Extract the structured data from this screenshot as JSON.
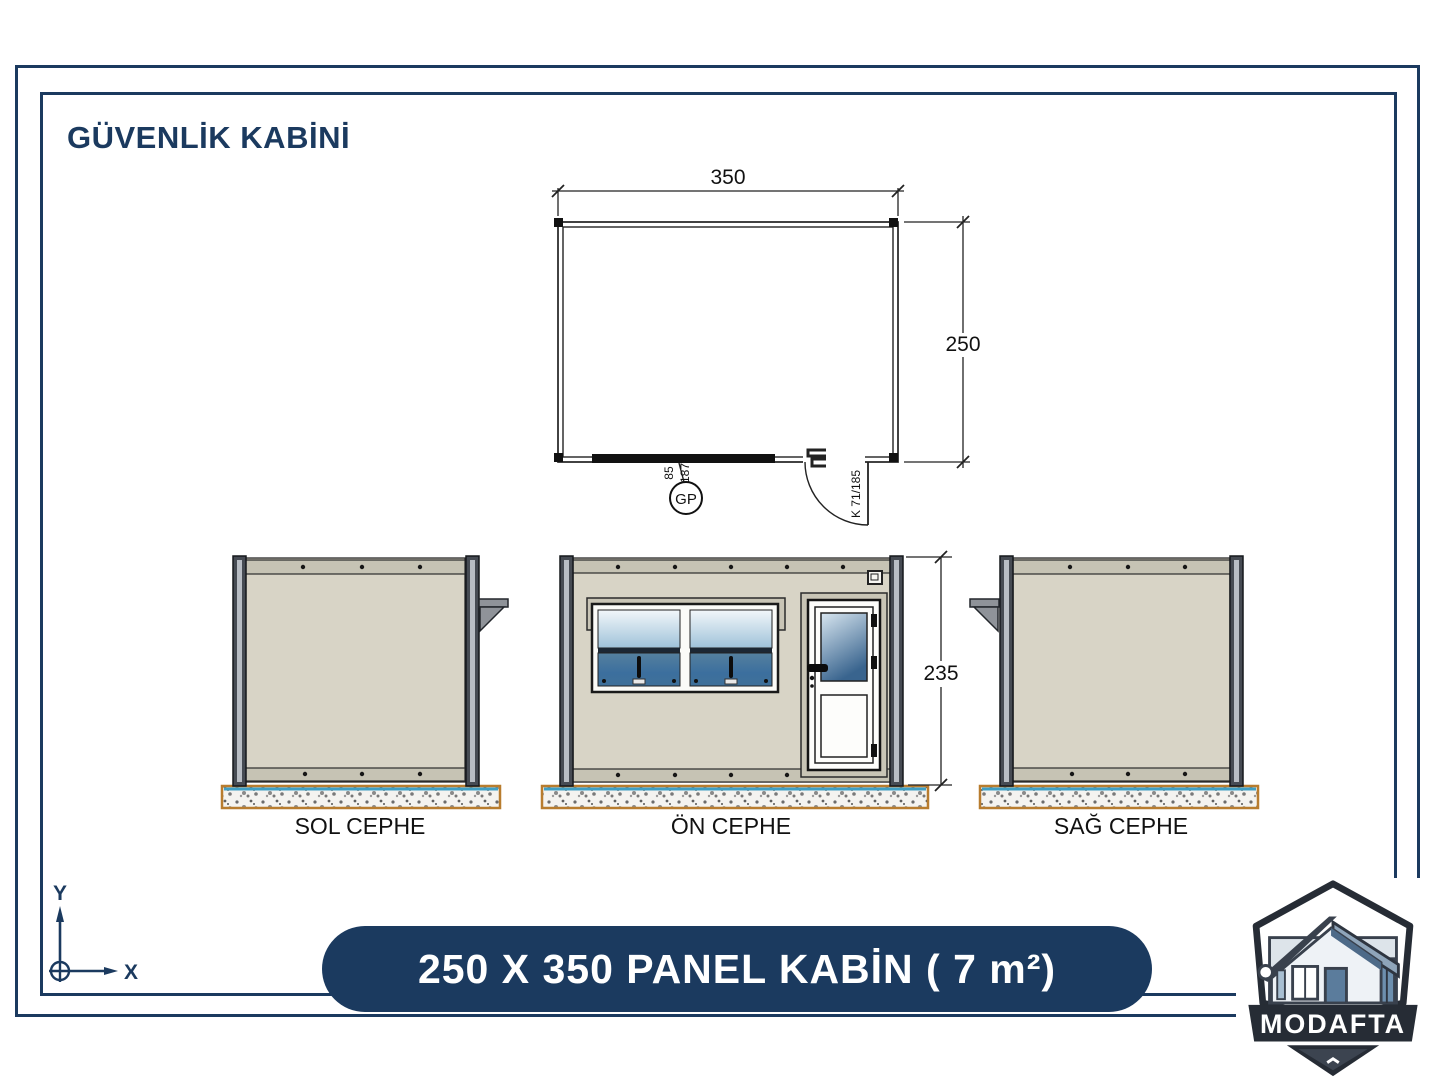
{
  "page": {
    "title": "GÜVENLİK KABİNİ",
    "banner": "250 X 350 PANEL KABİN  ( 7 m²)"
  },
  "plan": {
    "width_dim": "350",
    "height_dim": "250",
    "glass_panel_tag": "GP",
    "glass_panel_width": "85",
    "glass_panel_height": "187",
    "door_code": "K 71/185"
  },
  "elevations": {
    "left_label": "SOL CEPHE",
    "front_label": "ÖN CEPHE",
    "right_label": "SAĞ CEPHE",
    "height_dim": "235"
  },
  "axes": {
    "x": "X",
    "y": "Y"
  },
  "logo": {
    "brand": "MODAFTA"
  },
  "colors": {
    "navy": "#1b3a5f",
    "drawing_line": "#222222",
    "panel_beige": "#d8d4c6",
    "frame_gray": "#464b53",
    "glass_blue_light": "#cfe2ef",
    "glass_blue_dark": "#2f5f8e",
    "ground_border_orange": "#b87c2e",
    "ground_water_blue": "#3f9fc4",
    "banner_text": "#ffffff"
  }
}
